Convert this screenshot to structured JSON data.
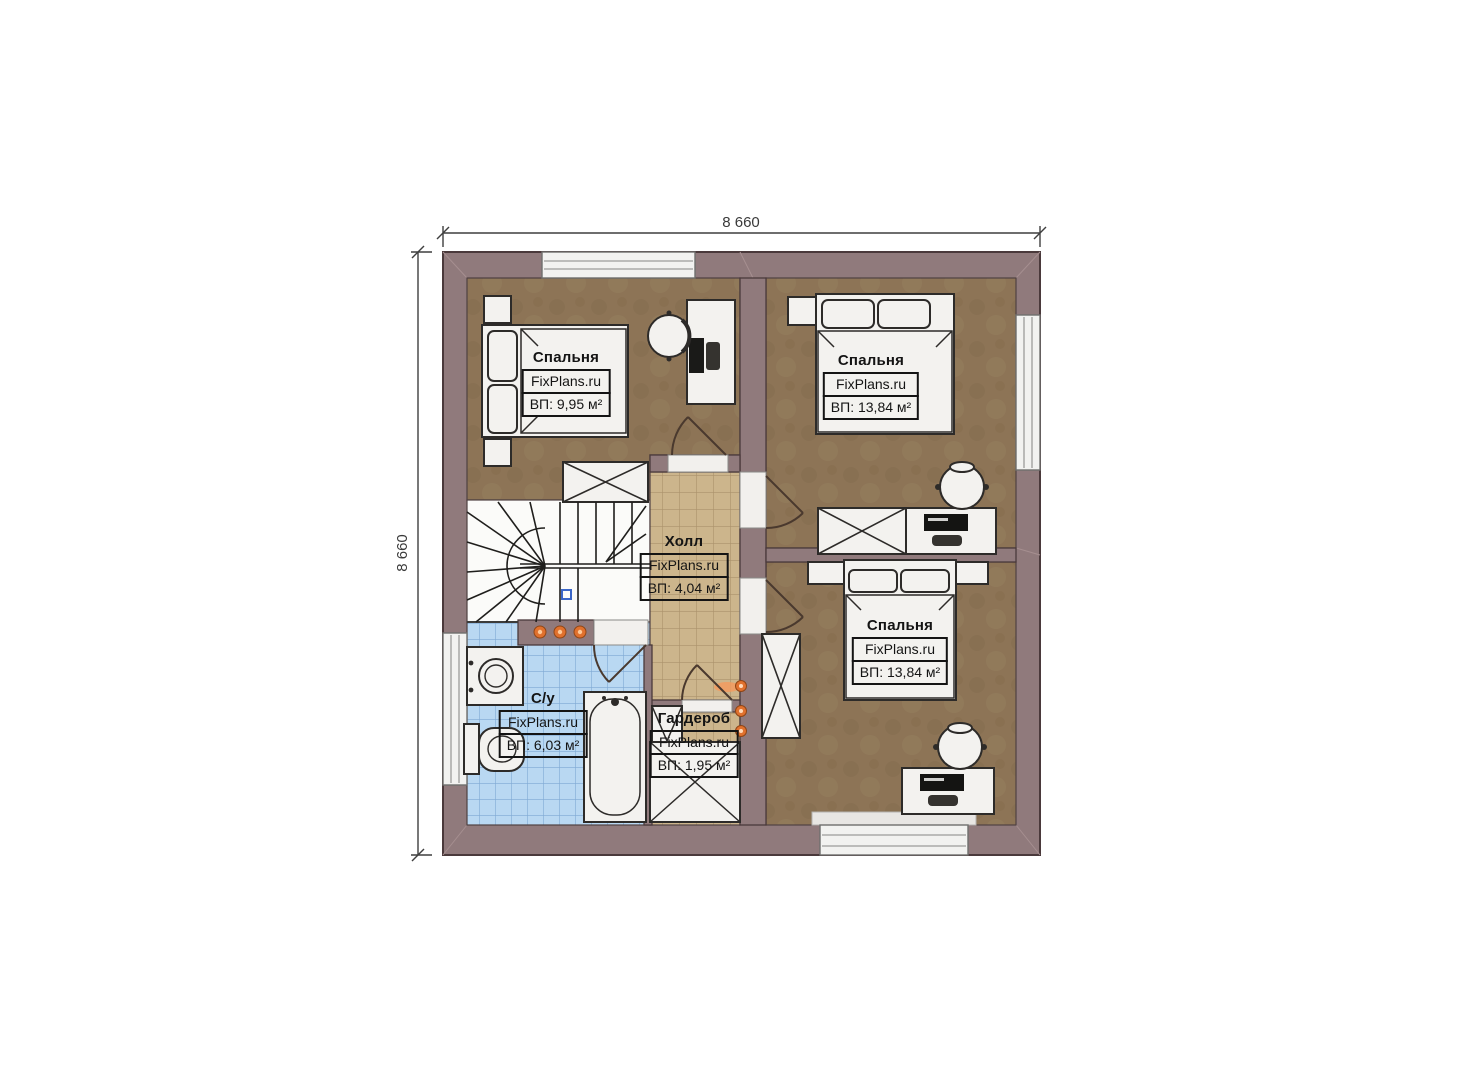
{
  "dimensions": {
    "top": "8 660",
    "left": "8 660"
  },
  "rooms": {
    "bedroom_top_left": {
      "name": "Спальня",
      "brand": "FixPlans.ru",
      "area": "ВП: 9,95 м²"
    },
    "bedroom_top_right": {
      "name": "Спальня",
      "brand": "FixPlans.ru",
      "area": "ВП: 13,84 м²"
    },
    "bedroom_bottom_right": {
      "name": "Спальня",
      "brand": "FixPlans.ru",
      "area": "ВП: 13,84 м²"
    },
    "hall": {
      "name": "Холл",
      "brand": "FixPlans.ru",
      "area": "ВП: 4,04 м²"
    },
    "bathroom": {
      "name": "С/у",
      "brand": "FixPlans.ru",
      "area": "ВП: 6,03 м²"
    },
    "wardrobe": {
      "name": "Гардероб",
      "brand": "FixPlans.ru",
      "area": "ВП: 1,95 м²"
    }
  },
  "colors": {
    "wall": "#907a7c",
    "bedroom_floor": "#8d7456",
    "hall_floor": "#ccb58c",
    "bath_tile": "#b9d8f2",
    "stairs": "#fbfbf9",
    "accent_light": "#e0712e",
    "dimension_text": "#3a3a3a"
  }
}
